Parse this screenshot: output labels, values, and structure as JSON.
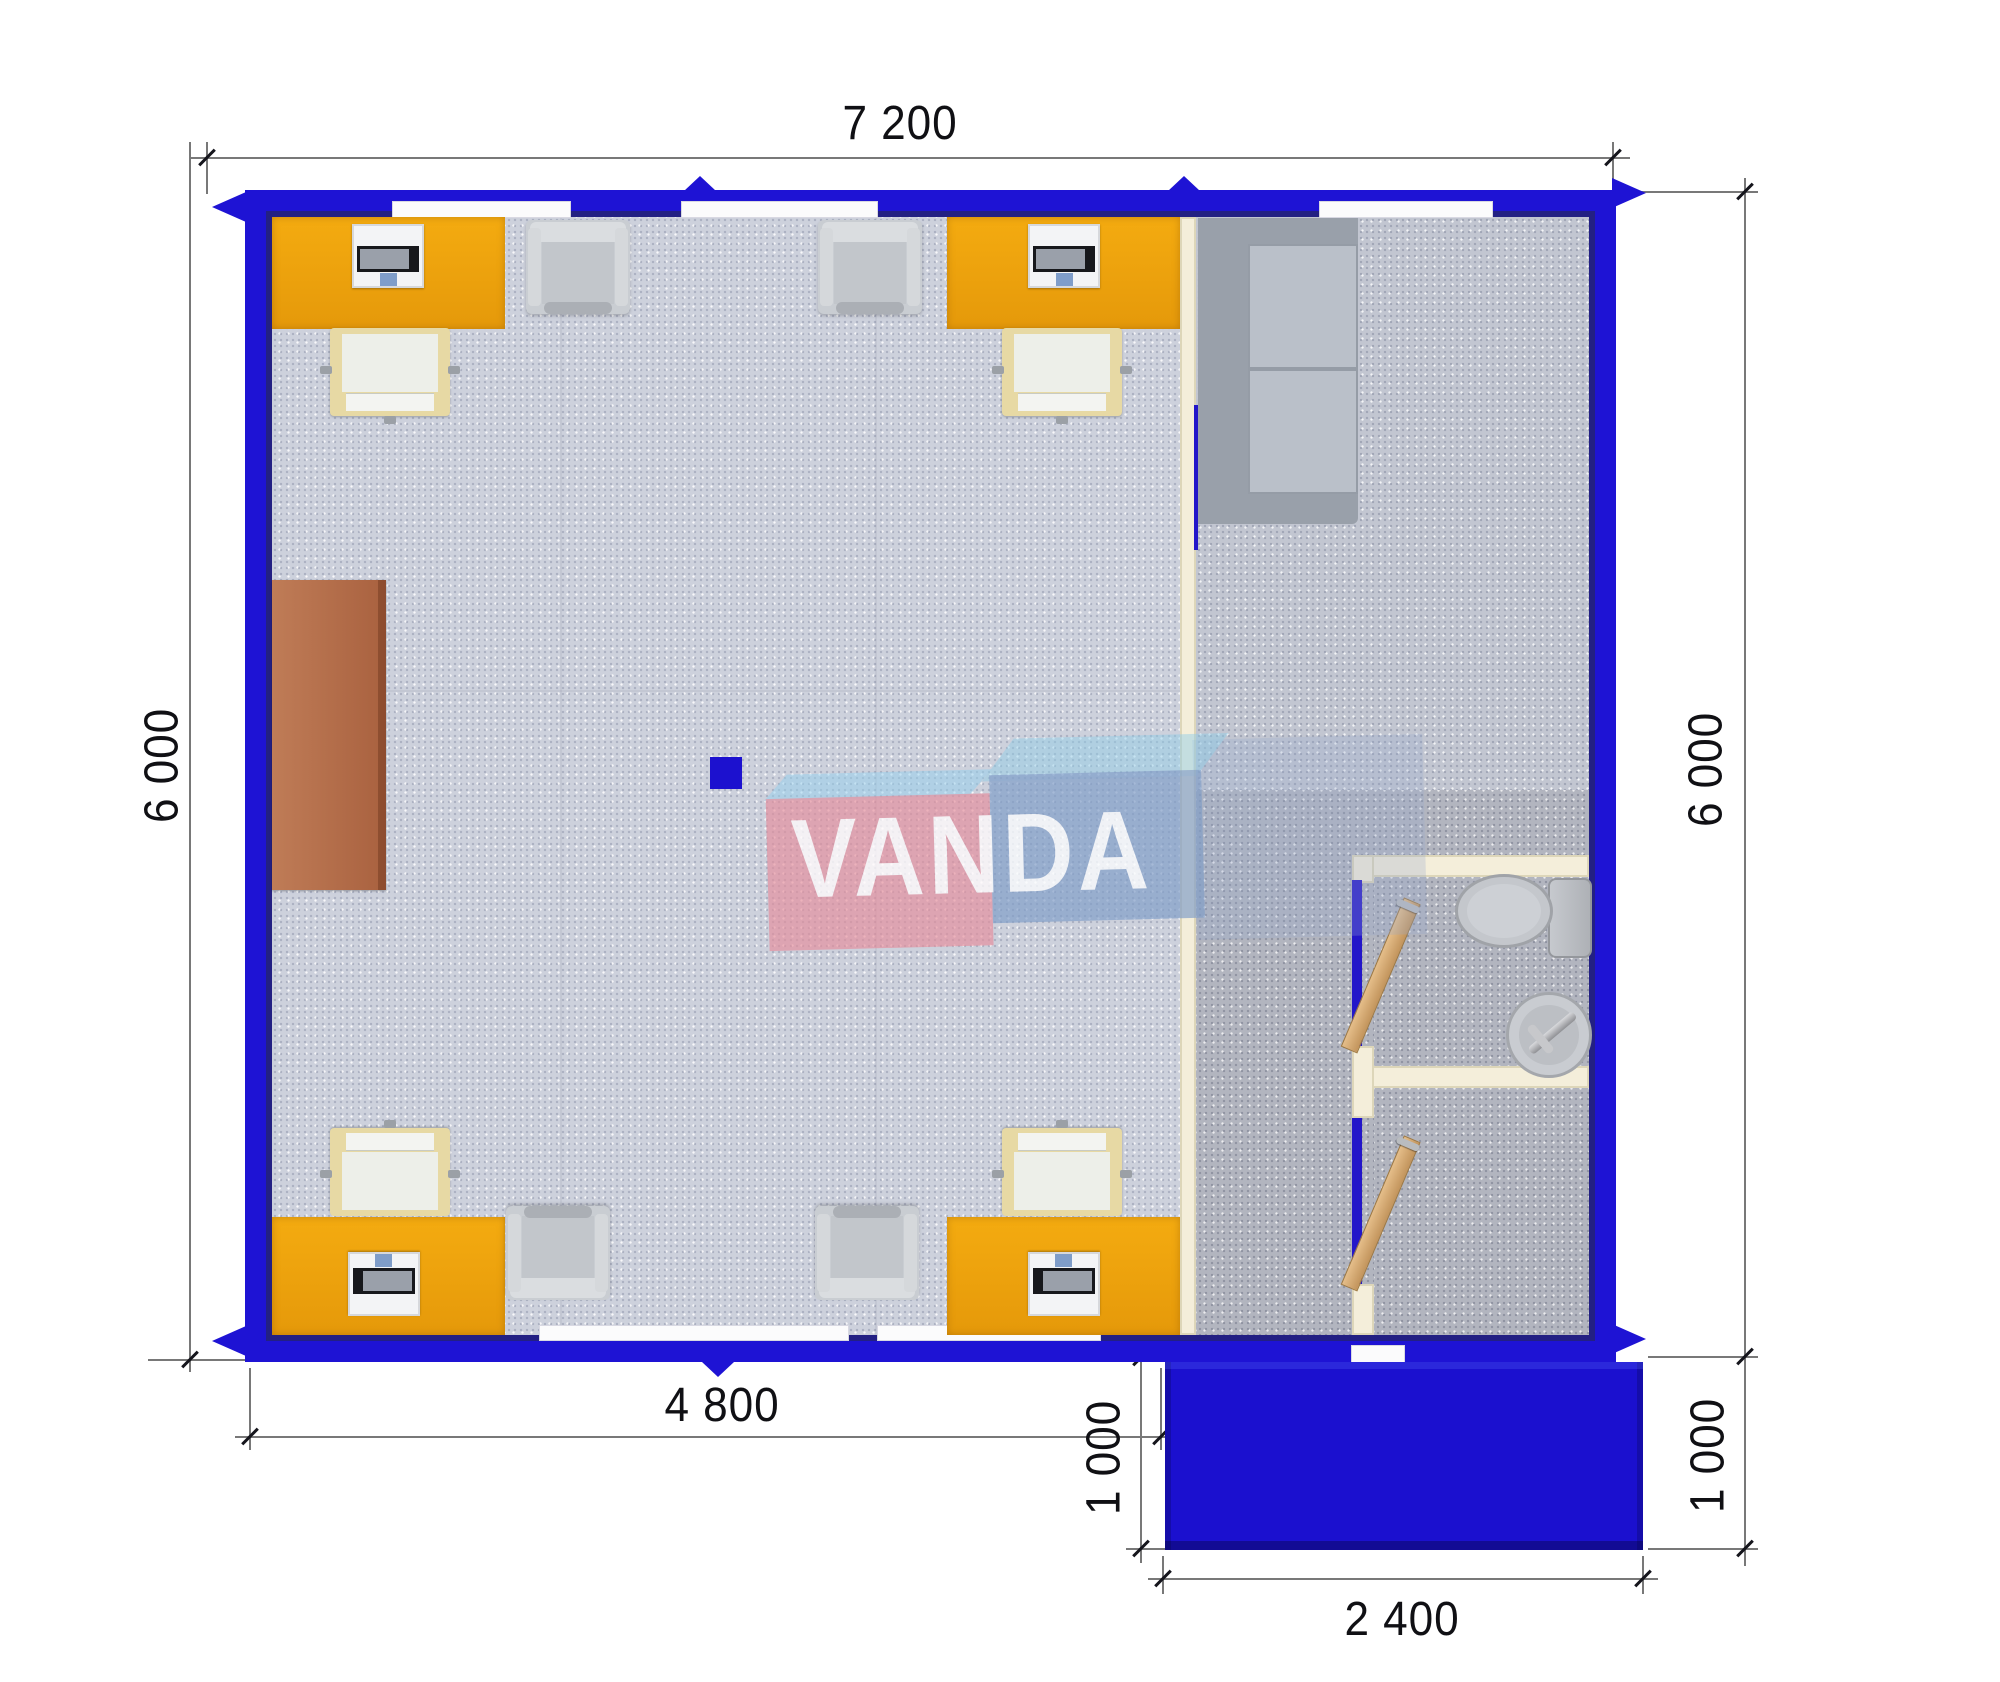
{
  "drawing": {
    "type": "floor-plan-top-view",
    "brand_watermark": "VANDA"
  },
  "watermark": {
    "text": "VANDA"
  },
  "dimensions": {
    "top": "7 200",
    "left": "6 000",
    "right": "6 000",
    "bottom_inner": "4 800",
    "porch_left": "1 000",
    "porch_bottom": "2 400",
    "porch_right": "1 000"
  },
  "colors": {
    "wall_blue": "#1e13d4",
    "porch_blue": "#1b10cf",
    "desk_orange": "#eda10d",
    "floor_office": "#cdd1dc",
    "floor_hall": "#b2b5bf",
    "partition_cream": "#f4eeda",
    "sofa_gray": "#b6bcc4",
    "sideboard_brown": "#b26845",
    "door_wood": "#d9b07b",
    "logo_pink": "#e68e9c",
    "logo_blue": "#809ec8",
    "dimension_text": "#101014"
  },
  "furniture": {
    "desks": 4,
    "desk_computers": 4,
    "task_chairs": 4,
    "visitor_armchairs": 4,
    "sofa": 1,
    "sideboard": 1,
    "toilet": 1,
    "sink": 1,
    "interior_doors": 2,
    "structural_column": 1
  }
}
